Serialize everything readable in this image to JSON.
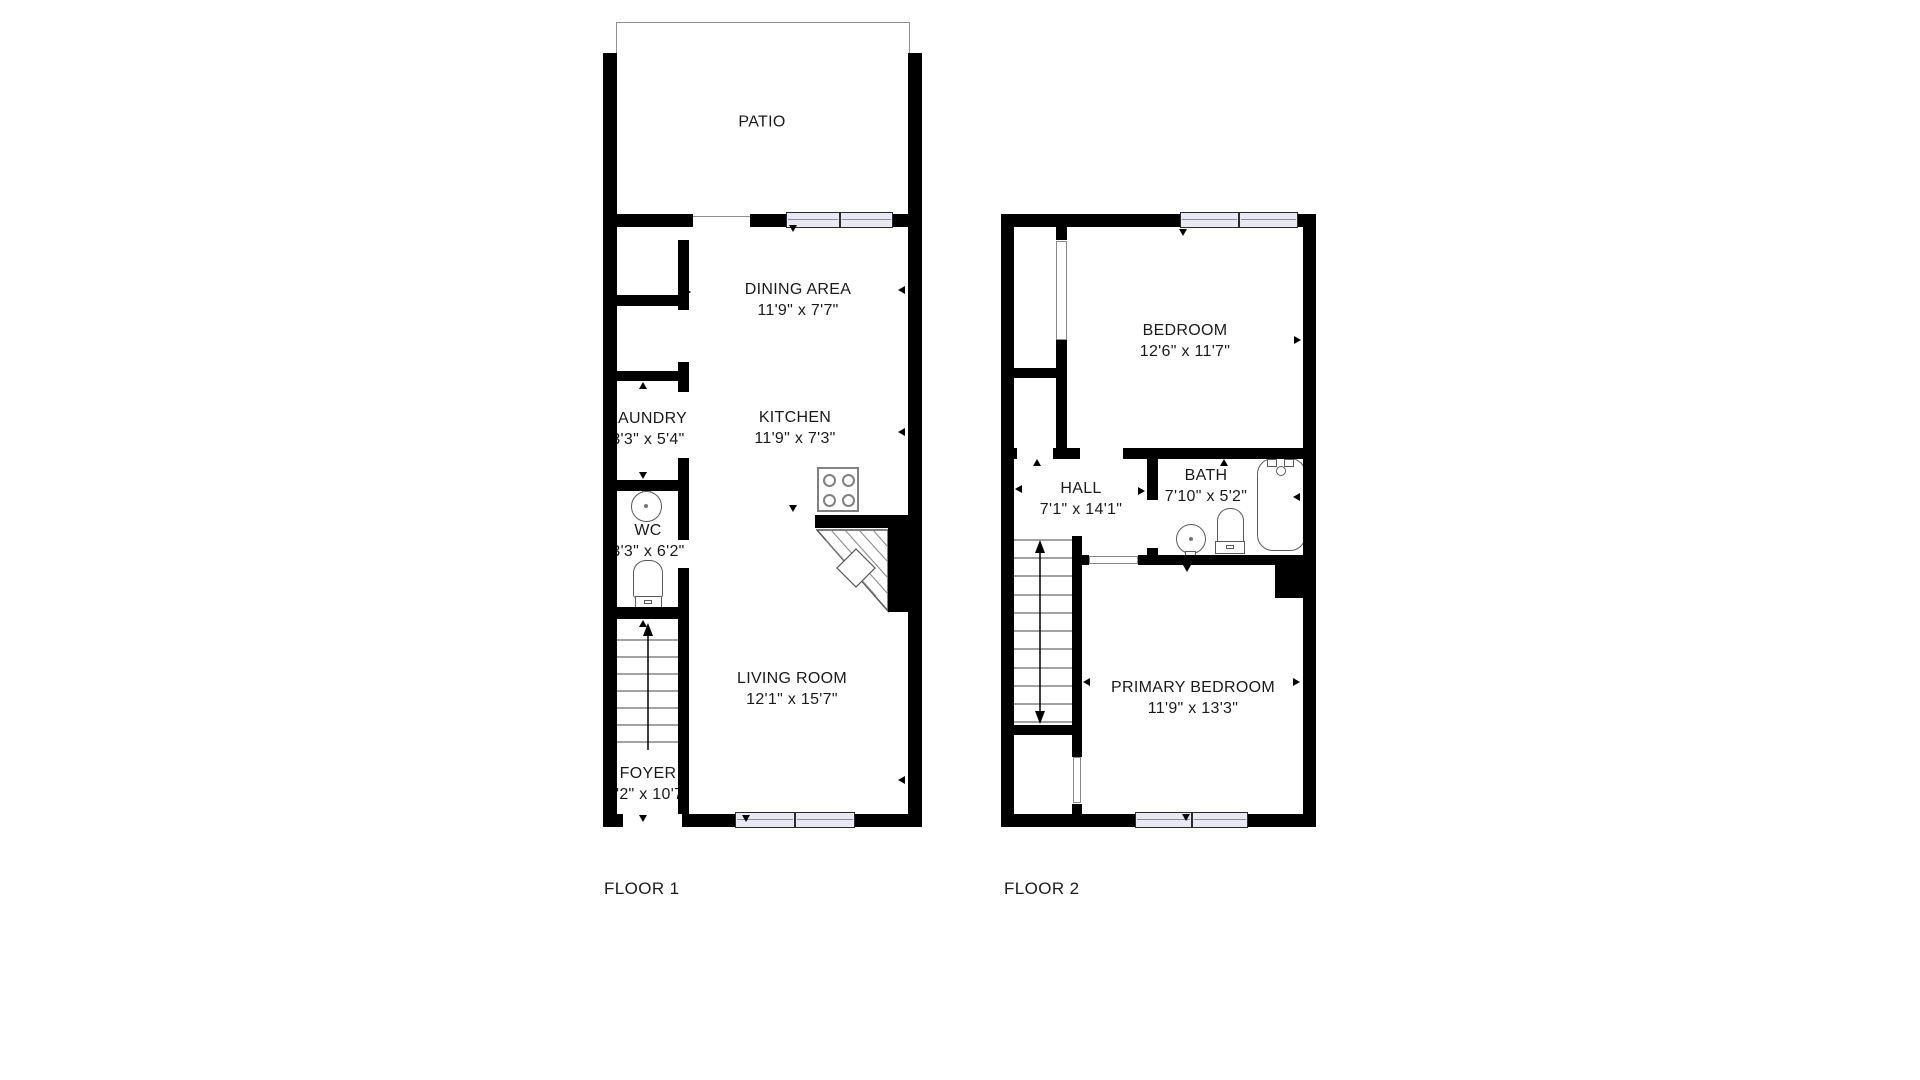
{
  "floors": {
    "floor1": {
      "label": "FLOOR 1",
      "rooms": {
        "patio": {
          "name": "PATIO",
          "dims": ""
        },
        "dining": {
          "name": "DINING AREA",
          "dims": "11'9\" x 7'7\""
        },
        "kitchen": {
          "name": "KITCHEN",
          "dims": "11'9\" x 7'3\""
        },
        "laundry": {
          "name": "LAUNDRY",
          "dims": "3'3\" x 5'4\""
        },
        "wc": {
          "name": "WC",
          "dims": "3'3\" x 6'2\""
        },
        "living": {
          "name": "LIVING ROOM",
          "dims": "12'1\" x 15'7\""
        },
        "foyer": {
          "name": "FOYER",
          "dims": "3'2\" x 10'7\""
        }
      }
    },
    "floor2": {
      "label": "FLOOR 2",
      "rooms": {
        "bedroom": {
          "name": "BEDROOM",
          "dims": "12'6\" x 11'7\""
        },
        "hall": {
          "name": "HALL",
          "dims": "7'1\" x 14'1\""
        },
        "bath": {
          "name": "BATH",
          "dims": "7'10\" x 5'2\""
        },
        "primary": {
          "name": "PRIMARY BEDROOM",
          "dims": "11'9\" x 13'3\""
        }
      }
    }
  },
  "colors": {
    "wall": "#000000",
    "window_fill": "#e9e9f3",
    "fixture_outline": "#5a5a5a",
    "patio_outline": "#909090",
    "text": "#1a1a1a"
  },
  "fixtures": [
    "sink-icon",
    "toilet-icon",
    "bathtub-icon",
    "stove-icon",
    "stairs-icon",
    "winder-stairs-icon"
  ]
}
